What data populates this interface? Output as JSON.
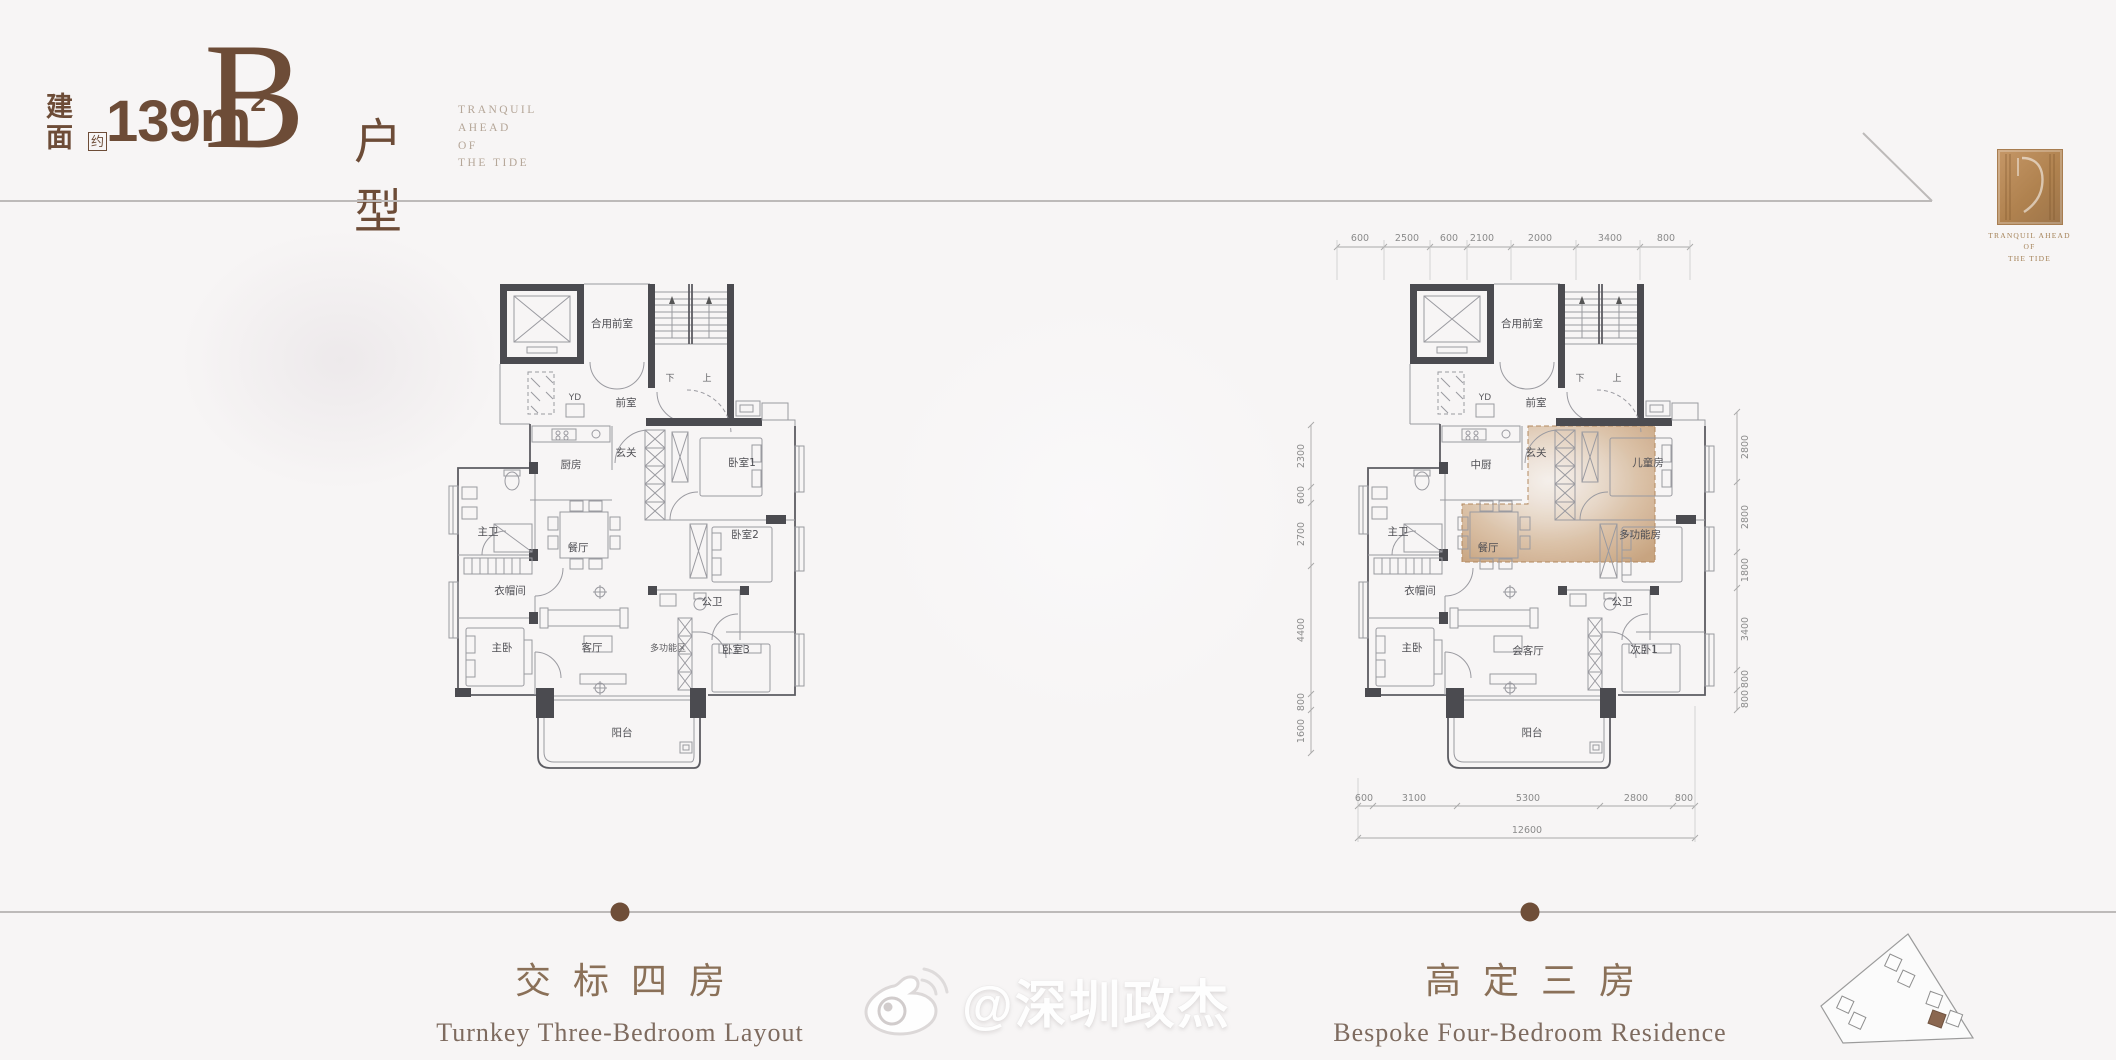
{
  "header": {
    "area_char1": "建",
    "area_char2": "面",
    "approx": "约",
    "area_value": "139m",
    "area_sup": "2",
    "type_letter": "B",
    "type_suffix": "户型",
    "tagline_lines": [
      "TRANQUIL AHEAD",
      "OF",
      "THE TIDE"
    ]
  },
  "logo": {
    "tagline_lines": [
      "TRANQUIL AHEAD",
      "OF",
      "THE TIDE"
    ]
  },
  "captions": {
    "left": {
      "zh": "交标四房",
      "en": "Turnkey Three-Bedroom Layout"
    },
    "right": {
      "zh": "高定三房",
      "en": "Bespoke Four-Bedroom Residence"
    }
  },
  "watermark": {
    "text": "@深圳政杰",
    "icon": "weibo-icon"
  },
  "colors": {
    "accent_brown": "#6d4c37",
    "caption_brown": "#8a7058",
    "divider_gray": "#bdbab9",
    "wall_dark": "#4b4b50",
    "highlight_tan": "#c79c72",
    "dot_brown": "#6f4e38"
  },
  "plans": {
    "left": {
      "title": "交标四房",
      "rooms": [
        {
          "label": "合用前室",
          "x": 612,
          "y": 327
        },
        {
          "label": "前室",
          "x": 626,
          "y": 406
        },
        {
          "label": "下",
          "x": 670,
          "y": 381,
          "small": true
        },
        {
          "label": "上",
          "x": 707,
          "y": 381,
          "small": true
        },
        {
          "label": "YD",
          "x": 575,
          "y": 400,
          "small": true
        },
        {
          "label": "厨房",
          "x": 571,
          "y": 468
        },
        {
          "label": "玄关",
          "x": 626,
          "y": 456
        },
        {
          "label": "卧室1",
          "x": 742,
          "y": 466
        },
        {
          "label": "餐厅",
          "x": 578,
          "y": 551
        },
        {
          "label": "卧室2",
          "x": 745,
          "y": 538
        },
        {
          "label": "主卫",
          "x": 488,
          "y": 535
        },
        {
          "label": "衣帽间",
          "x": 510,
          "y": 594
        },
        {
          "label": "公卫",
          "x": 712,
          "y": 605
        },
        {
          "label": "主卧",
          "x": 502,
          "y": 651
        },
        {
          "label": "客厅",
          "x": 592,
          "y": 651
        },
        {
          "label": "多功能区",
          "x": 668,
          "y": 651,
          "small": true
        },
        {
          "label": "卧室3",
          "x": 736,
          "y": 653
        },
        {
          "label": "阳台",
          "x": 622,
          "y": 736
        }
      ]
    },
    "right": {
      "title": "高定三房",
      "rooms": [
        {
          "label": "合用前室",
          "x": 1522,
          "y": 327
        },
        {
          "label": "前室",
          "x": 1536,
          "y": 406
        },
        {
          "label": "下",
          "x": 1580,
          "y": 381,
          "small": true
        },
        {
          "label": "上",
          "x": 1617,
          "y": 381,
          "small": true
        },
        {
          "label": "YD",
          "x": 1485,
          "y": 400,
          "small": true
        },
        {
          "label": "中厨",
          "x": 1481,
          "y": 468
        },
        {
          "label": "玄关",
          "x": 1536,
          "y": 456
        },
        {
          "label": "儿童房",
          "x": 1648,
          "y": 466
        },
        {
          "label": "餐厅",
          "x": 1488,
          "y": 551
        },
        {
          "label": "多功能房",
          "x": 1640,
          "y": 538
        },
        {
          "label": "主卫",
          "x": 1398,
          "y": 535
        },
        {
          "label": "衣帽间",
          "x": 1420,
          "y": 594
        },
        {
          "label": "公卫",
          "x": 1622,
          "y": 605
        },
        {
          "label": "主卧",
          "x": 1412,
          "y": 651
        },
        {
          "label": "会客厅",
          "x": 1528,
          "y": 654
        },
        {
          "label": "次卧1",
          "x": 1644,
          "y": 653
        },
        {
          "label": "阳台",
          "x": 1532,
          "y": 736
        }
      ],
      "dims": {
        "top": {
          "y": 241,
          "items": [
            {
              "t": "600",
              "x": 1360
            },
            {
              "t": "2500",
              "x": 1407
            },
            {
              "t": "600",
              "x": 1449
            },
            {
              "t": "2100",
              "x": 1482
            },
            {
              "t": "2000",
              "x": 1540
            },
            {
              "t": "3400",
              "x": 1610
            },
            {
              "t": "800",
              "x": 1666
            }
          ]
        },
        "bottom": {
          "y": 801,
          "items": [
            {
              "t": "600",
              "x": 1364
            },
            {
              "t": "3100",
              "x": 1414
            },
            {
              "t": "5300",
              "x": 1528
            },
            {
              "t": "2800",
              "x": 1636
            },
            {
              "t": "800",
              "x": 1684
            }
          ]
        },
        "total": {
          "t": "12600",
          "x": 1527,
          "y": 833
        },
        "left": {
          "x": 1304,
          "items": [
            {
              "t": "2300",
              "y": 456
            },
            {
              "t": "600",
              "y": 495
            },
            {
              "t": "2700",
              "y": 534
            },
            {
              "t": "4400",
              "y": 630
            },
            {
              "t": "800",
              "y": 702
            },
            {
              "t": "1600",
              "y": 731
            }
          ]
        },
        "right": {
          "x": 1748,
          "items": [
            {
              "t": "2800",
              "y": 447
            },
            {
              "t": "2800",
              "y": 517
            },
            {
              "t": "1800",
              "y": 570
            },
            {
              "t": "3400",
              "y": 629
            },
            {
              "t": "800",
              "y": 679
            },
            {
              "t": "800",
              "y": 699
            }
          ]
        }
      }
    }
  }
}
